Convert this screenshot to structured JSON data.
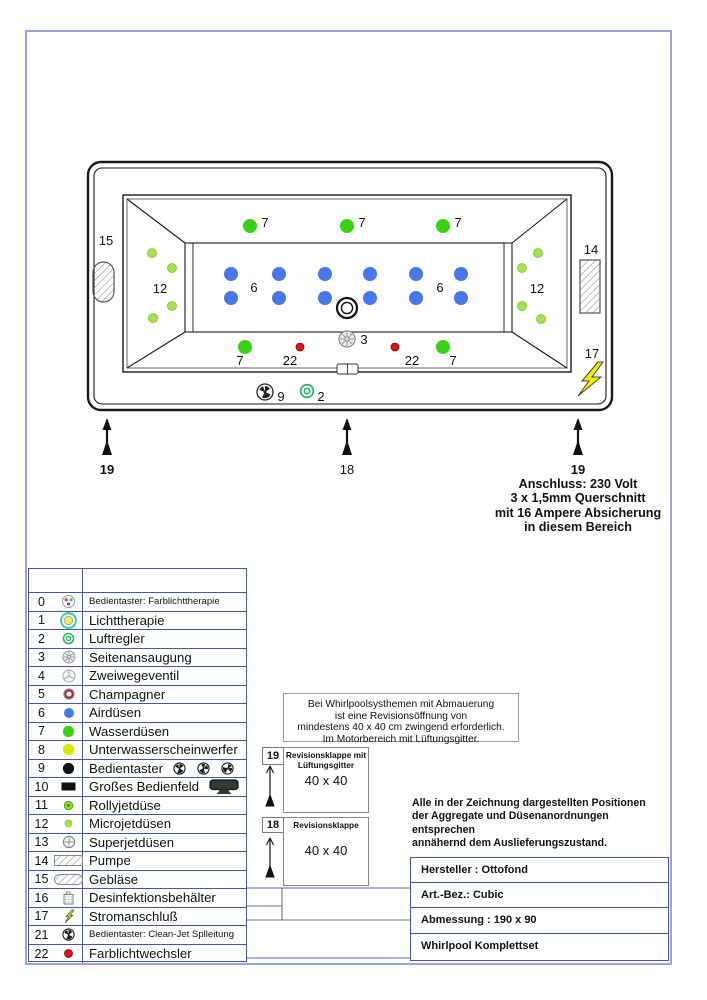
{
  "tub": {
    "wasserduesen": {
      "label": "7",
      "color": "#3bd117",
      "r": 7,
      "dots": [
        [
          250,
          226
        ],
        [
          347,
          226
        ],
        [
          443,
          226
        ],
        [
          245,
          347
        ],
        [
          443,
          347
        ]
      ],
      "labels": [
        [
          265,
          227
        ],
        [
          362,
          227
        ],
        [
          458,
          227
        ],
        [
          240,
          365
        ],
        [
          453,
          365
        ]
      ]
    },
    "airduesen": {
      "label": "6",
      "color": "#4a77e8",
      "r": 7,
      "dots": [
        [
          231,
          274
        ],
        [
          279,
          274
        ],
        [
          325,
          274
        ],
        [
          370,
          274
        ],
        [
          416,
          274
        ],
        [
          461,
          274
        ],
        [
          231,
          298
        ],
        [
          279,
          298
        ],
        [
          325,
          298
        ],
        [
          370,
          298
        ],
        [
          416,
          298
        ],
        [
          461,
          298
        ]
      ],
      "labels": [
        [
          254,
          292
        ],
        [
          440,
          292
        ]
      ]
    },
    "microjets": {
      "label": "12",
      "color": "#a9e14e",
      "r": 4.5,
      "dots": [
        [
          152,
          253
        ],
        [
          172,
          268
        ],
        [
          172,
          306
        ],
        [
          153,
          318
        ],
        [
          538,
          253
        ],
        [
          522,
          268
        ],
        [
          522,
          306
        ],
        [
          541,
          319
        ]
      ],
      "labels": [
        [
          160,
          293
        ],
        [
          537,
          293
        ]
      ]
    },
    "farblichtwechsler": {
      "label": "22",
      "color": "#e0101e",
      "r": 4,
      "dots": [
        [
          300,
          347
        ],
        [
          395,
          347
        ]
      ],
      "labels": [
        [
          290,
          365
        ],
        [
          412,
          365
        ]
      ]
    },
    "point_labels": [
      {
        "name": "seitenansaugung-label",
        "label": "3",
        "x": 364,
        "y": 344
      },
      {
        "name": "bedientaster-label",
        "label": "9",
        "x": 281,
        "y": 401
      },
      {
        "name": "luftregler-label",
        "label": "2",
        "x": 321,
        "y": 401
      },
      {
        "name": "geblaese-label",
        "label": "15",
        "x": 106,
        "y": 245
      },
      {
        "name": "pumpe-label",
        "label": "14",
        "x": 591,
        "y": 254
      },
      {
        "name": "stromanschluss-label",
        "label": "17",
        "x": 592,
        "y": 358
      }
    ]
  },
  "arrows": [
    {
      "x": 107,
      "label": "19",
      "bold": true
    },
    {
      "x": 347,
      "label": "18",
      "bold": false
    },
    {
      "x": 578,
      "label": "19",
      "bold": true
    }
  ],
  "anschluss_lines": [
    "Anschluss: 230 Volt",
    "3 x 1,5mm Querschnitt",
    "mit 16 Ampere Absicherung",
    "in diesem Bereich"
  ],
  "notice_lines": [
    "Bei Whirlpoolsysthemen mit Abmauerung",
    "ist eine Revisionsöffnung von",
    "mindestens 40 x 40 cm zwingend erforderlich.",
    "Im Motorbereich mit Lüftungsgitter."
  ],
  "rev19": {
    "num": "19",
    "line1": "Revisionsklappe mit",
    "line2": "Lüftungsgitter",
    "size": "40 x 40"
  },
  "rev18": {
    "num": "18",
    "line1": "Revisionsklappe",
    "size": "40 x 40"
  },
  "position_note_lines": [
    "Alle in der Zeichnung dargestellten Positionen",
    "der Aggregate und Düsenanordnungen entsprechen",
    "annähernd dem Auslieferungszustand."
  ],
  "info_table_rows": [
    "Hersteller : Ottofond",
    "Art.-Bez.:  Cubic",
    "Abmessung : 190 x 90",
    "Whirlpool Komplettset"
  ],
  "legend": {
    "rows": [
      {
        "num": "0",
        "icon": "btn-farblicht-icon",
        "label": "Bedientaster: Farblichttherapie",
        "small": true
      },
      {
        "num": "1",
        "icon": "lichttherapie-icon",
        "label": "Lichttherapie"
      },
      {
        "num": "2",
        "icon": "luftregler-icon",
        "label": "Luftregler"
      },
      {
        "num": "3",
        "icon": "seitenansaugung-icon",
        "label": "Seitenansaugung"
      },
      {
        "num": "4",
        "icon": "zweiwegeventil-icon",
        "label": "Zweiwegeventil"
      },
      {
        "num": "5",
        "icon": "champagner-icon",
        "label": "Champagner"
      },
      {
        "num": "6",
        "icon": "airduese-icon",
        "label": "Airdüsen"
      },
      {
        "num": "7",
        "icon": "wasserduese-icon",
        "label": "Wasserdüsen"
      },
      {
        "num": "8",
        "icon": "unterwasserscheinwerfer-icon",
        "label": "Unterwasserscheinwerfer"
      },
      {
        "num": "9",
        "icon": "bedientaster-icon",
        "label": "Bedientaster",
        "extra": "fans3"
      },
      {
        "num": "10",
        "icon": "bedienfeld-icon",
        "label": "Großes Bedienfeld",
        "extra": "panel"
      },
      {
        "num": "11",
        "icon": "rollyjet-icon",
        "label": "Rollyjetdüse"
      },
      {
        "num": "12",
        "icon": "microjet-icon",
        "label": "Microjetdüsen"
      },
      {
        "num": "13",
        "icon": "superjet-icon",
        "label": "Superjetdüsen"
      },
      {
        "num": "14",
        "icon": "pumpe-icon",
        "label": "Pumpe"
      },
      {
        "num": "15",
        "icon": "geblaese-icon",
        "label": "Gebläse"
      },
      {
        "num": "16",
        "icon": "desinfektion-icon",
        "label": "Desinfektionsbehälter"
      },
      {
        "num": "17",
        "icon": "strom-icon",
        "label": "Stromanschluß"
      },
      {
        "num": "21",
        "icon": "cleanjet-icon",
        "label": "Bedientaster:  Clean-Jet Splleitung",
        "small": true
      },
      {
        "num": "22",
        "icon": "farblichtwechsler-icon",
        "label": "Farblichtwechsler"
      }
    ]
  },
  "colors": {
    "border_blue": "#4a569b",
    "page_border": "#9aa3da",
    "jet_green": "#3bd117",
    "jet_blue": "#4a77e8",
    "micro_green": "#a9e14e",
    "red": "#e0101e",
    "underwater_yellow": "#d8e900",
    "lightning_yellow": "#e8ef00"
  }
}
